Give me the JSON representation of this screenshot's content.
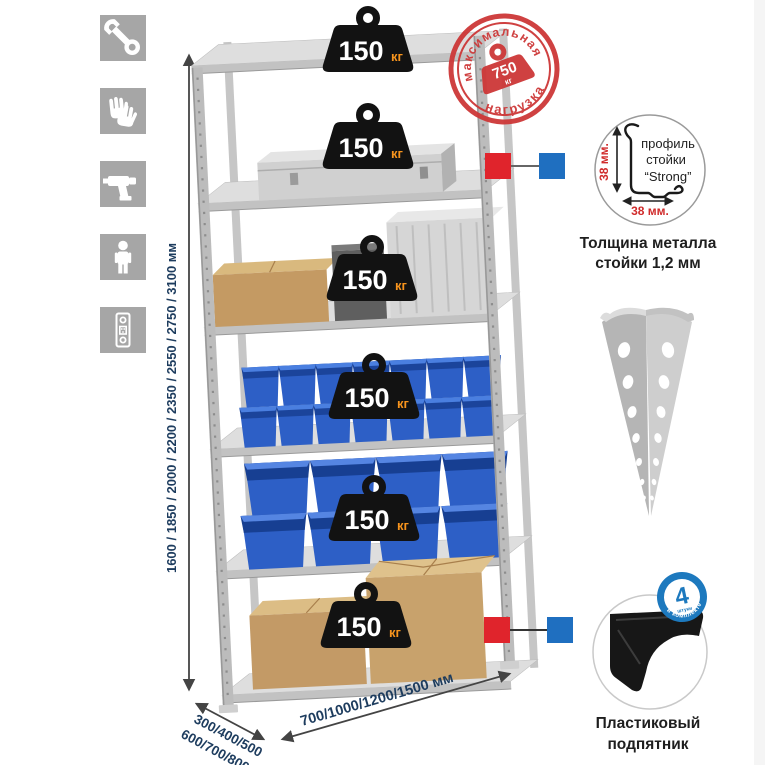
{
  "icons": {
    "items": [
      "wrench",
      "gloves",
      "drill",
      "person",
      "upright-profile"
    ]
  },
  "dimensions": {
    "height": "1600 / 1850 / 2000 / 2200 / 2350 / 2550 / 2750 / 3100 мм",
    "depth_line1": "300/400/500",
    "depth_line2": "600/700/800 мм",
    "width": "700/1000/1200/1500 мм"
  },
  "rack": {
    "shelf_count": 6,
    "load_per_shelf": {
      "value": "150",
      "unit": "кг"
    }
  },
  "stamp": {
    "text_top": "максимальная",
    "text_bottom": "нагрузка",
    "value": "750",
    "unit": "кг"
  },
  "profile_detail": {
    "dim_vertical": "38 мм.",
    "dim_horizontal": "38 мм.",
    "label_line1": "профиль",
    "label_line2": "стойки",
    "label_line3": "“Strong”",
    "caption_line1": "Толщина металла",
    "caption_line2": "стойки 1,2 мм"
  },
  "foot_detail": {
    "badge_value": "4",
    "badge_sub": "штуки",
    "badge_arc": "в комплекте",
    "caption_line1": "Пластиковый",
    "caption_line2": "подпятник"
  },
  "colors": {
    "marker_red": "#e0242c",
    "marker_blue": "#1f6fc0",
    "stamp_red": "#cd3737",
    "dim_text": "#1d3c5e",
    "bin_blue": "#2d5fc6",
    "unit_orange": "#f7941d",
    "badge_blue": "#1d79be"
  }
}
